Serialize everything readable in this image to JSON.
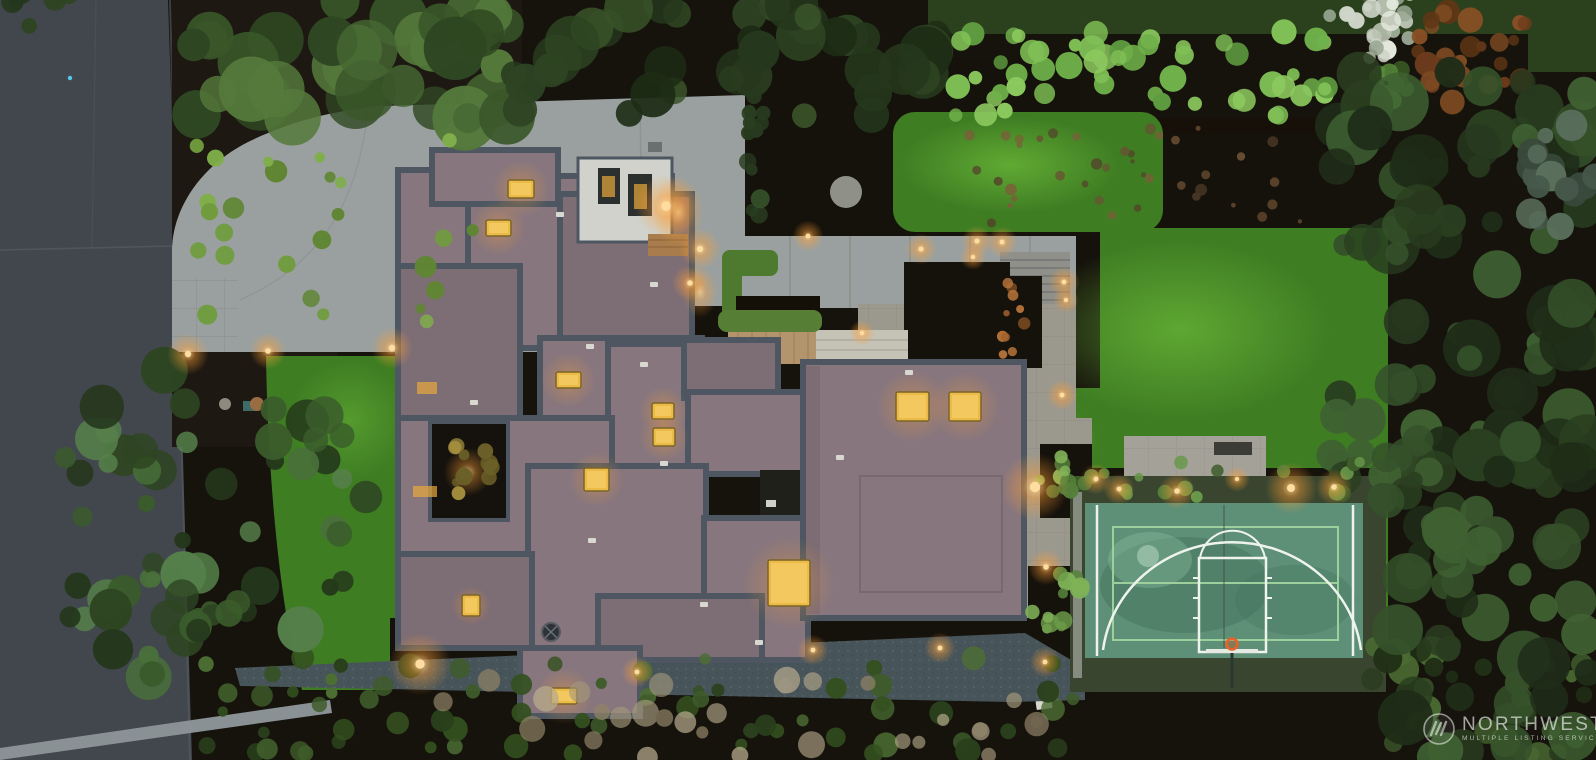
{
  "image": {
    "type": "aerial-drone-photograph",
    "subject": "modern flat-roof estate at dusk with driveway, terraced gardens, lawns and a sport court",
    "time_of_day": "dusk"
  },
  "watermark": {
    "logo": "northwest-mls-monogram",
    "line1": "NORTHWEST",
    "line2": "MULTIPLE LISTING SERVICE"
  },
  "palette": {
    "road": "#42474d",
    "road_line": "#565c62",
    "concrete": "#9aa09f",
    "paver": "#9b988e",
    "paver_line": "#85827a",
    "mulch": "#1d1812",
    "mulch_dark": "#15110b",
    "lawn": "#3f7d23",
    "lawn_hi": "#60ad33",
    "lawn_neighbor": "#2b401d",
    "hedge_bright": "#5f9c40",
    "forest": "#24341d",
    "roof": "#87767e",
    "roof_dark": "#7d6d75",
    "parapet": "#4e5761",
    "skylight": "#ecba46",
    "glow": "#ffb042",
    "court": "#5e8f77",
    "court_shadow": "#47765f",
    "court_line_white": "#eef3ec",
    "court_line_green": "#9ccf9b",
    "hoop_orange": "#e8632a",
    "wood": "#b3946c",
    "gravel": "#47545a",
    "white_wall": "#d0d2cb",
    "watermark": "#ffffff"
  },
  "scene": {
    "skylights": [
      [
        508,
        180,
        26,
        18
      ],
      [
        486,
        220,
        25,
        16
      ],
      [
        556,
        372,
        25,
        16
      ],
      [
        584,
        468,
        25,
        23
      ],
      [
        652,
        403,
        22,
        16
      ],
      [
        653,
        428,
        22,
        18
      ],
      [
        462,
        595,
        18,
        21
      ],
      [
        551,
        688,
        26,
        16
      ],
      [
        896,
        392,
        33,
        29
      ],
      [
        949,
        392,
        32,
        29
      ],
      [
        768,
        560,
        42,
        46
      ]
    ],
    "lit_slots": [
      [
        417,
        382,
        20,
        12
      ],
      [
        413,
        486,
        24,
        11
      ],
      [
        602,
        176,
        13,
        21
      ],
      [
        634,
        184,
        13,
        25
      ]
    ],
    "vents": [
      [
        586,
        344
      ],
      [
        640,
        362
      ],
      [
        470,
        400
      ],
      [
        660,
        461
      ],
      [
        588,
        538
      ],
      [
        755,
        640
      ],
      [
        700,
        602
      ],
      [
        905,
        370
      ],
      [
        836,
        455
      ],
      [
        556,
        212
      ],
      [
        650,
        282
      ]
    ],
    "lights": [
      [
        188,
        354,
        8
      ],
      [
        268,
        351,
        7
      ],
      [
        392,
        348,
        8
      ],
      [
        420,
        664,
        12
      ],
      [
        637,
        672,
        6
      ],
      [
        813,
        650,
        6
      ],
      [
        940,
        648,
        6
      ],
      [
        700,
        249,
        8
      ],
      [
        690,
        283,
        7
      ],
      [
        666,
        206,
        12
      ],
      [
        808,
        236,
        6
      ],
      [
        921,
        249,
        6
      ],
      [
        977,
        241,
        6
      ],
      [
        1002,
        242,
        6
      ],
      [
        973,
        257,
        5
      ],
      [
        1064,
        282,
        6
      ],
      [
        1066,
        300,
        5
      ],
      [
        862,
        333,
        5
      ],
      [
        1035,
        487,
        13
      ],
      [
        1046,
        567,
        7
      ],
      [
        1045,
        662,
        6
      ],
      [
        1062,
        395,
        6
      ],
      [
        1096,
        479,
        6
      ],
      [
        1119,
        489,
        6
      ],
      [
        1177,
        491,
        7
      ],
      [
        1237,
        479,
        5
      ],
      [
        1291,
        488,
        10
      ],
      [
        1334,
        487,
        7
      ]
    ],
    "foliage": [
      {
        "name": "twig-texture-beds",
        "type": "scatter",
        "box": [
          960,
          128,
          370,
          95
        ],
        "count": 40,
        "r": [
          2,
          6
        ],
        "colors": [
          "#6b4f33",
          "#7d5c3a",
          "#54402a"
        ],
        "op": 0.8,
        "seed": 11
      },
      {
        "name": "planter-coral-plants",
        "type": "scatter",
        "box": [
          1002,
          282,
          34,
          78
        ],
        "count": 10,
        "r": [
          3,
          7
        ],
        "colors": [
          "#b06a32",
          "#c87f3e",
          "#8a5224"
        ],
        "op": 0.9,
        "seed": 12
      },
      {
        "name": "bottom-shrub-row",
        "type": "scatter",
        "box": [
          200,
          655,
          880,
          100
        ],
        "count": 70,
        "r": [
          5,
          13
        ],
        "colors": [
          "#34501f",
          "#3f5c2a",
          "#4c6e33",
          "#2a401c"
        ],
        "op": 1,
        "seed": 13
      },
      {
        "name": "bottom-pale-shrubs",
        "type": "scatter",
        "box": [
          430,
          680,
          640,
          78
        ],
        "count": 30,
        "r": [
          6,
          14
        ],
        "colors": [
          "#a3977b",
          "#b8ab8d",
          "#8f8266"
        ],
        "op": 0.75,
        "seed": 14
      },
      {
        "name": "bottom-right-shrubs",
        "type": "scatter",
        "box": [
          1370,
          640,
          226,
          118
        ],
        "count": 40,
        "r": [
          6,
          16
        ],
        "colors": [
          "#2a3d1f",
          "#3a5429",
          "#203016",
          "#4a6b33"
        ],
        "op": 1,
        "seed": 15
      },
      {
        "name": "hedge-top-left",
        "type": "scatter",
        "box": [
          190,
          0,
          330,
          122
        ],
        "count": 36,
        "r": [
          14,
          34
        ],
        "colors": [
          "#2f4722",
          "#3a5729",
          "#466832",
          "#54793b"
        ],
        "op": 1,
        "seed": 16
      },
      {
        "name": "tree-band-top",
        "type": "scatter",
        "box": [
          490,
          0,
          470,
          125
        ],
        "count": 40,
        "r": [
          12,
          28
        ],
        "colors": [
          "#25371c",
          "#2e4422",
          "#1d2c15",
          "#3a5429"
        ],
        "op": 1,
        "seed": 17
      },
      {
        "name": "bright-hedge-wall",
        "type": "scatter",
        "box": [
          952,
          30,
          382,
          90
        ],
        "count": 55,
        "r": [
          6,
          14
        ],
        "colors": [
          "#6fb04a",
          "#7fbf55",
          "#5f9c40",
          "#8cc95e"
        ],
        "op": 1,
        "seed": 18
      },
      {
        "name": "front-bed-shrub-mounds",
        "type": "scatter",
        "box": [
          190,
          140,
          300,
          190
        ],
        "count": 26,
        "r": [
          5,
          12
        ],
        "colors": [
          "#5f8633",
          "#6f9c3d",
          "#7fae4a"
        ],
        "op": 1,
        "seed": 19
      },
      {
        "name": "flowering-tree",
        "type": "cluster",
        "c": [
          1372,
          18
        ],
        "rx": 48,
        "ry": 40,
        "count": 28,
        "r": [
          4,
          11
        ],
        "colors": [
          "#cfd5c9",
          "#e6eadf",
          "#b9c2b0",
          "#9aa894"
        ],
        "op": 1,
        "seed": 20
      },
      {
        "name": "rust-tree",
        "type": "cluster",
        "c": [
          1475,
          55
        ],
        "rx": 62,
        "ry": 55,
        "count": 30,
        "r": [
          5,
          13
        ],
        "colors": [
          "#6e3c1c",
          "#8a4f24",
          "#5f3615",
          "#7d4a22"
        ],
        "op": 1,
        "seed": 21
      },
      {
        "name": "bright-conifer",
        "type": "cluster",
        "c": [
          1388,
          82
        ],
        "rx": 24,
        "ry": 30,
        "count": 12,
        "r": [
          5,
          11
        ],
        "colors": [
          "#4d7a33",
          "#5f9440",
          "#3d6128"
        ],
        "op": 1,
        "seed": 22
      },
      {
        "name": "evergreen-forest-upper",
        "type": "scatter",
        "box": [
          1335,
          48,
          261,
          385
        ],
        "count": 70,
        "r": [
          10,
          30
        ],
        "colors": [
          "#1f2d18",
          "#2a3f20",
          "#35512a",
          "#3f6132",
          "#27391e"
        ],
        "op": 1,
        "seed": 23
      },
      {
        "name": "frosted-evergreen",
        "type": "cluster",
        "c": [
          1565,
          165
        ],
        "rx": 55,
        "ry": 65,
        "count": 20,
        "r": [
          7,
          16
        ],
        "colors": [
          "#46584a",
          "#5a6f5c",
          "#394a3c"
        ],
        "op": 1,
        "seed": 24
      },
      {
        "name": "evergreen-forest-lower",
        "type": "scatter",
        "box": [
          1392,
          430,
          204,
          330
        ],
        "count": 55,
        "r": [
          10,
          28
        ],
        "colors": [
          "#1f2d18",
          "#2a3f20",
          "#35512a",
          "#3f6132"
        ],
        "op": 1,
        "seed": 25
      },
      {
        "name": "court-corner-trees",
        "type": "cluster",
        "c": [
          1385,
          465
        ],
        "rx": 55,
        "ry": 40,
        "count": 12,
        "r": [
          8,
          18
        ],
        "colors": [
          "#2a3f20",
          "#35512a",
          "#3f6132"
        ],
        "op": 1,
        "seed": 26
      },
      {
        "name": "street-evergreen-tree",
        "type": "cluster",
        "c": [
          205,
          525
        ],
        "rx": 168,
        "ry": 165,
        "count": 65,
        "r": [
          8,
          24
        ],
        "colors": [
          "#24371b",
          "#2e4522",
          "#3a5c2b",
          "#49703a",
          "#55804a"
        ],
        "op": 1,
        "seed": 27
      },
      {
        "name": "court-bed-shrubs",
        "type": "scatter",
        "box": [
          1048,
          460,
          320,
          40
        ],
        "count": 18,
        "r": [
          4,
          9
        ],
        "colors": [
          "#3f5c2a",
          "#55803a",
          "#68984a"
        ],
        "op": 1,
        "seed": 28
      },
      {
        "name": "patio-planter-tree-a",
        "type": "cluster",
        "c": [
          1062,
          478
        ],
        "rx": 27,
        "ry": 27,
        "count": 10,
        "r": [
          5,
          10
        ],
        "colors": [
          "#55803a",
          "#6b9c49",
          "#7fb258"
        ],
        "op": 1,
        "seed": 29
      },
      {
        "name": "patio-planter-tree-b",
        "type": "cluster",
        "c": [
          1058,
          600
        ],
        "rx": 30,
        "ry": 32,
        "count": 12,
        "r": [
          5,
          10
        ],
        "colors": [
          "#55803a",
          "#6b9c49",
          "#7fb258"
        ],
        "op": 1,
        "seed": 30
      },
      {
        "name": "courtyard-lit-tree",
        "type": "cluster",
        "c": [
          468,
          470
        ],
        "rx": 26,
        "ry": 30,
        "count": 12,
        "r": [
          4,
          9
        ],
        "colors": [
          "#8a7c3a",
          "#a8923f",
          "#6b6028"
        ],
        "op": 1,
        "seed": 31
      },
      {
        "name": "hedge-column",
        "type": "scatter",
        "box": [
          742,
          95,
          26,
          145
        ],
        "count": 14,
        "r": [
          5,
          10
        ],
        "colors": [
          "#2a3f20",
          "#35512a",
          "#27391e"
        ],
        "op": 1,
        "seed": 32
      },
      {
        "name": "corner-overhang",
        "type": "cluster",
        "c": [
          45,
          8
        ],
        "rx": 40,
        "ry": 22,
        "count": 8,
        "r": [
          6,
          14
        ],
        "colors": [
          "#25371c",
          "#2e4422"
        ],
        "op": 1,
        "seed": 33
      }
    ]
  }
}
